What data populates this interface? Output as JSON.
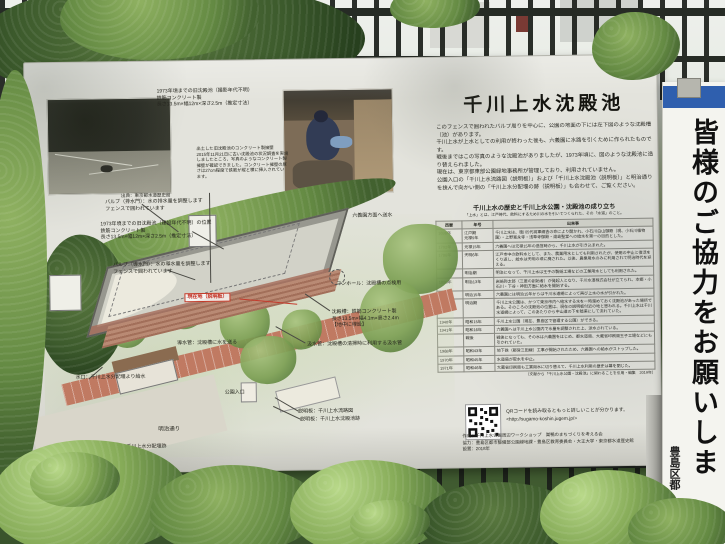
{
  "colors": {
    "panel": "#e3e3dc",
    "accent_red": "#c22b1e",
    "banner_blue": "#2f5fae",
    "fence": "#1c201c",
    "foliage": "#6f9a4e"
  },
  "sign": {
    "left": {
      "photo1_note": "1973年頃までの旧沈殿池（撮影年代不明）\n鉄筋コンクリート製\n長さ13.5m×幅12m×深さ2.5m（推定寸法）",
      "photo1_caption": "出典：東京都水道歴史館",
      "excavation_note": "出土した旧沈殿池のコンクリート製擁壁\n2015年11月21日に古い沈殿池の状況調査を実施しましたところ、写真のようなコンクリート製擁壁が確認できました。コンクリート擁壁の厚さは27cm程度で鉄筋が縦と横に挿入されています。"
    },
    "diagram": {
      "valve_drain": "バルブ（排水門）：水の排水量を調整します\nフェンスで囲われています",
      "old_pond_position": "1973年頃までの旧沈殿池（建設年代不明）の位置\n鉄筋コンクリート製\n長さ13.5m×幅12m×深さ2.5m（推定寸法）",
      "valve_inlet": "バルブ（導水門）：水の導水量を調整します\nフェンスで囲われています",
      "to_rikugien": "六義園方面へ送水",
      "manhole": "マンホール：沈殿槽の点検用",
      "tank": "沈殿槽：鉄筋コンクリート製\n長さ13.5m×幅4.1m×高さ2.4m\n【地中に埋設】",
      "suction_pipe": "汲水管：沈殿槽の清掃時に利用する汲水管",
      "current_location": "現在地（説明板）",
      "conduit": "導水管：沈殿槽に水を送る",
      "park_entrance": "公園入口",
      "intake": "水口：千川上水分配堰より給水",
      "meiji_street": "明治通り",
      "signboard_bunpaiseki": "説明板：千川上水分配堰跡",
      "signboard_flowmap": "説明板：千川上水流路図",
      "signboard_pond": "説明板：千川上水沈殿池跡"
    },
    "right": {
      "title": "千川上水沈殿池",
      "intro": "このフェンスで囲われたバルブ周りを中心に、公園の地面の下には左下図のような沈殿槽（池）があります。\n千川上水が上水としての利用が終わった後も、六義園に水路を引くために作られたものです。\n戦後まではこの写真のような沈殿池がありましたが、1973年頃に、図のような沈殿池に造り替えられました。\n現在は、東京都東部公園緑地事務所が管理しており、利用されていません。\n公園入口の「千川上水流路図（説明板）」および「千川上水沈殿池（説明板）」と明治通りを挟んで向かい側の「千川上水分配堰の跡（説明板）」も合わせて、ご覧ください。",
      "table": {
        "title": "千川上水の歴史と千川上水公園・沈殿池の成り立ち",
        "subtitle": "「上水」とは、江戸時代、飲料にするため川の水を引いてつくられた、その「水道」のこと。",
        "headers": [
          "西暦",
          "年号",
          "出来事"
        ],
        "rows": [
          [
            "1696年",
            "江戸期\n元禄9年",
            "千川上水は、徳川5代将軍綱吉の命により開かれ、小石川白山御殿（現、小石川植物園）・上野寛永寺・浅草寺御殿・湯島聖堂への給水を第一の目的とした。"
          ],
          [
            "1702年",
            "元禄15年",
            "六義園へは元禄15年の造営時から、千川上水が引き込まれた。"
          ],
          [
            "1786年",
            "天明6年",
            "江戸市中の飲料水として、また、農業用水としても利用されたが、使用の中止と復活をくり返し、給水は天明の頃に廃された。以後、農業用水のみに利用されて明治時代を迎える。"
          ],
          [
            "",
            "明治期",
            "明治になって、千川上水は王子の製紙工場などの工業用水としても利用された。"
          ],
          [
            "1880年",
            "明治13年",
            "岩崎弥太郎（三菱の創始者）が発起人となり、千川水道株式会社が立てられ、本郷・小石川・下谷・神田方面に給水を開始する。"
          ],
          [
            "1882年",
            "明治15年",
            "六義園には明治15年からは千川水道網によって再び上水の水が引かれた。"
          ],
          [
            "",
            "明治期",
            "千川上水公園は、かつて東京市内へ給水する水を一時溜めておく沈殿池があった場所である。そのころの沈殿池の位置は、現在の説明板付近の地と思われる。千川上水は千川水道網によって、このあたりから中山道の下を暗渠にして流れていた。"
          ],
          [
            "1940年",
            "昭和15年",
            "千川上水公園（現在、豊島区で管理する公園）ができる。"
          ],
          [
            "1941年",
            "昭和16年",
            "六義園へは千川上水公園内で水量を調整された上、送水されている。"
          ],
          [
            "",
            "戦後",
            "戦後になっても、その水は六義園をはじめ、都水道局、大蔵省印刷局王子工場などにも引かれていた。"
          ],
          [
            "1968年",
            "昭和43年",
            "地下鉄（都営三田線）工事が開始されたため、六義園への給水がストップした。"
          ],
          [
            "1970年",
            "昭和45年",
            "水道局が取水を中止。"
          ],
          [
            "1971年",
            "昭和46年",
            "大蔵省印刷局も工業用水に切り替えて、千川上水利用の歴史は幕を閉じた。"
          ]
        ],
        "source": "（文献から「千川上水公園・沈殿池」に関わることを引用・編集　2019年）"
      },
      "qr_caption": "QRコードを読み取るともっと詳しいことが分かります。",
      "qr_url": "<http://sugamo-koshin.jugem.jp/>",
      "credits": "作成：千川上水公園周辺ワークショップ　巣鴨のまちづくりを考える会\n協力：豊島区都市整備部公園緑地課・豊島区教育委員会・大正大学・東京都水道歴史館\n設置：2018年"
    }
  },
  "banner": {
    "text": "皆様のご協力をお願いしま",
    "footer": "豊島区都"
  }
}
